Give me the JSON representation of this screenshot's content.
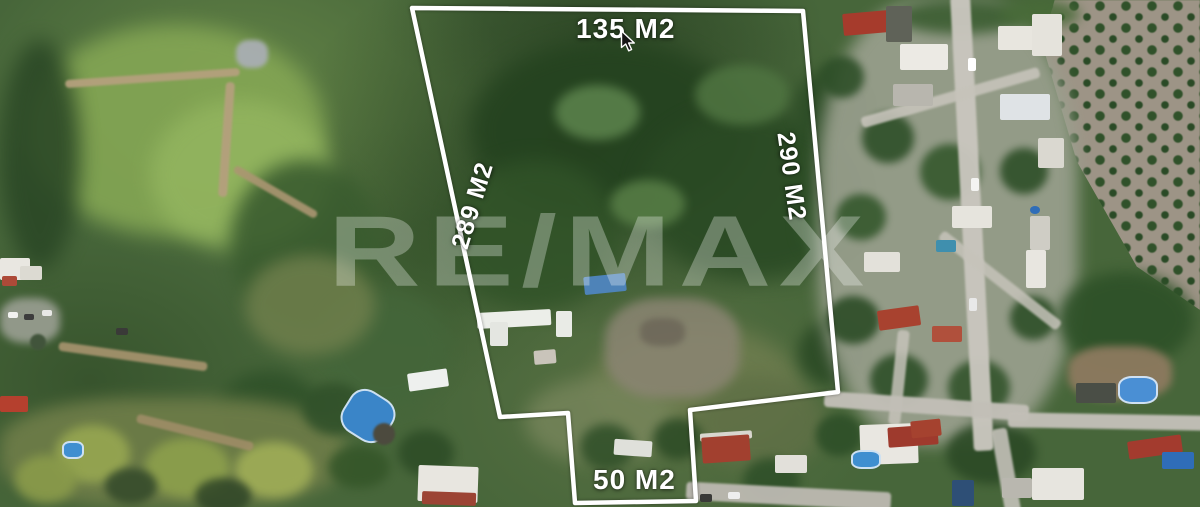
{
  "scene": {
    "description": "Aerial drone photograph of a land parcel with a white property boundary overlay",
    "watermark": "RE/MAX",
    "measurements": {
      "top": "135 M2",
      "left": "289 M2",
      "right": "290 M2",
      "bottom": "50 M2"
    },
    "colors": {
      "boundary_line": "#ffffff",
      "measurement_text": "#ffffff",
      "watermark_text": "#ffffff",
      "forest_dark": "#24421f",
      "forest_mid": "#3a5c2f",
      "meadow_light": "#84a654",
      "dirt_path": "#b4a07d",
      "street_gray": "#c9c6be",
      "roof_red": "#a33b2e",
      "roof_white": "#eceae4",
      "pool_blue": "#3a85c8",
      "orchard_soil": "#9d9486"
    }
  }
}
